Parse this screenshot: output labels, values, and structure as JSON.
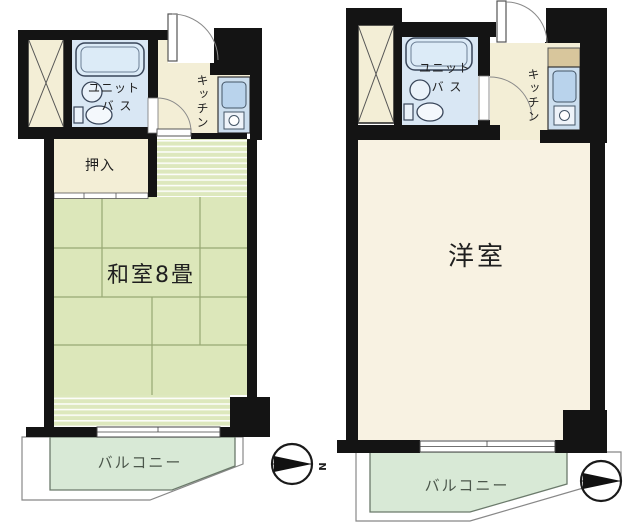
{
  "document": {
    "type": "apartment-floorplans",
    "plan_count": 2
  },
  "colors": {
    "wall": "#141414",
    "cream": "#f3eed6",
    "bath_floor": "#d9e7f4",
    "kitchen_unit": "#ccdeee",
    "kitchen_sink": "#b9d3ec",
    "counter": "#d8c69c",
    "tatami": "#dce7ba",
    "stripe_base": "#dde8bd",
    "western_room": "#f8f2e2",
    "balcony": "#d8e9d6"
  },
  "left_plan": {
    "unit_bath_label_line1": "ユニット",
    "unit_bath_label_line2": "バ ス",
    "kitchen_label": "キッチン",
    "closet_label": "押入",
    "room_label": "和室8畳",
    "balcony_label": "バルコニー",
    "compass_north_label": "N"
  },
  "right_plan": {
    "unit_bath_label_line1": "ユニット",
    "unit_bath_label_line2": "バ ス",
    "kitchen_label": "キッチン",
    "room_label": "洋室",
    "balcony_label": "バルコニー"
  }
}
